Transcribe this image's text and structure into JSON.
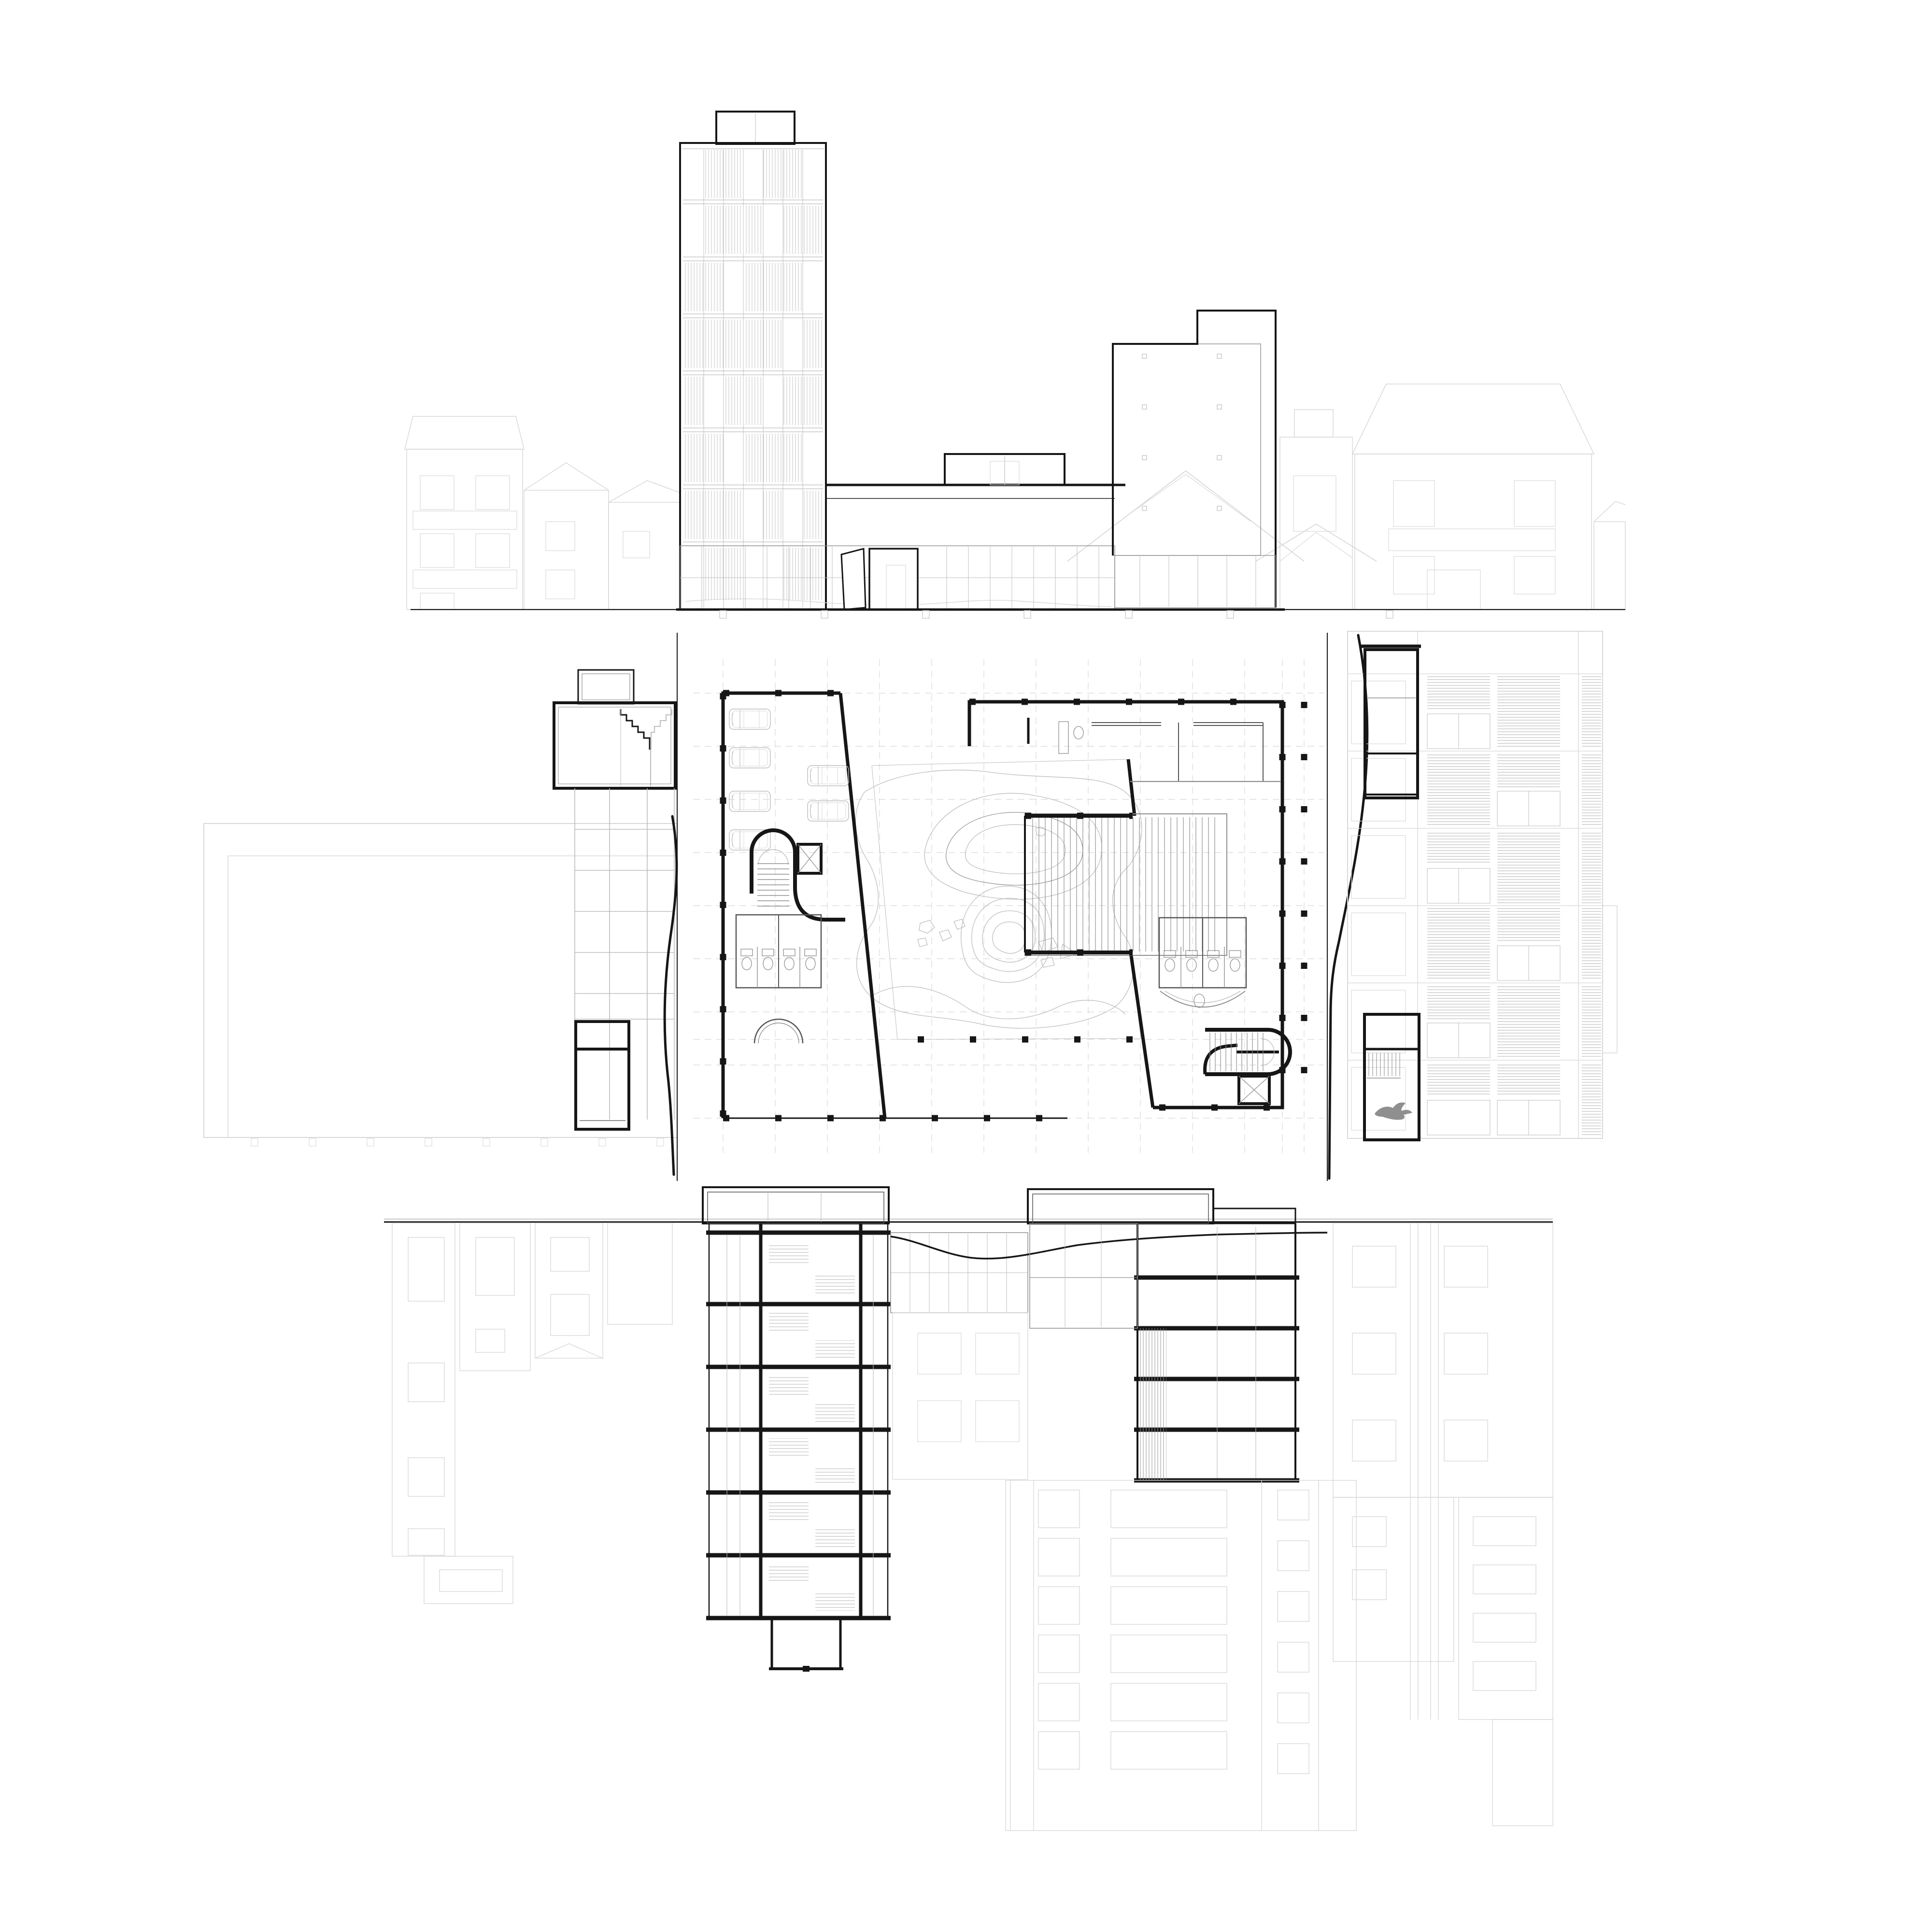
{
  "drawing": {
    "kind": "architectural-plan-and-elevations-sheet",
    "text_content": "none"
  },
  "palette": {
    "bg": "#ffffff",
    "ink": "#161616",
    "mid": "#555555",
    "gray": "#8f8f8f",
    "light": "#bdbdbd",
    "faint": "#d8d8d8",
    "faintest": "#e8e8e8",
    "bird": "#8f8f8f"
  }
}
